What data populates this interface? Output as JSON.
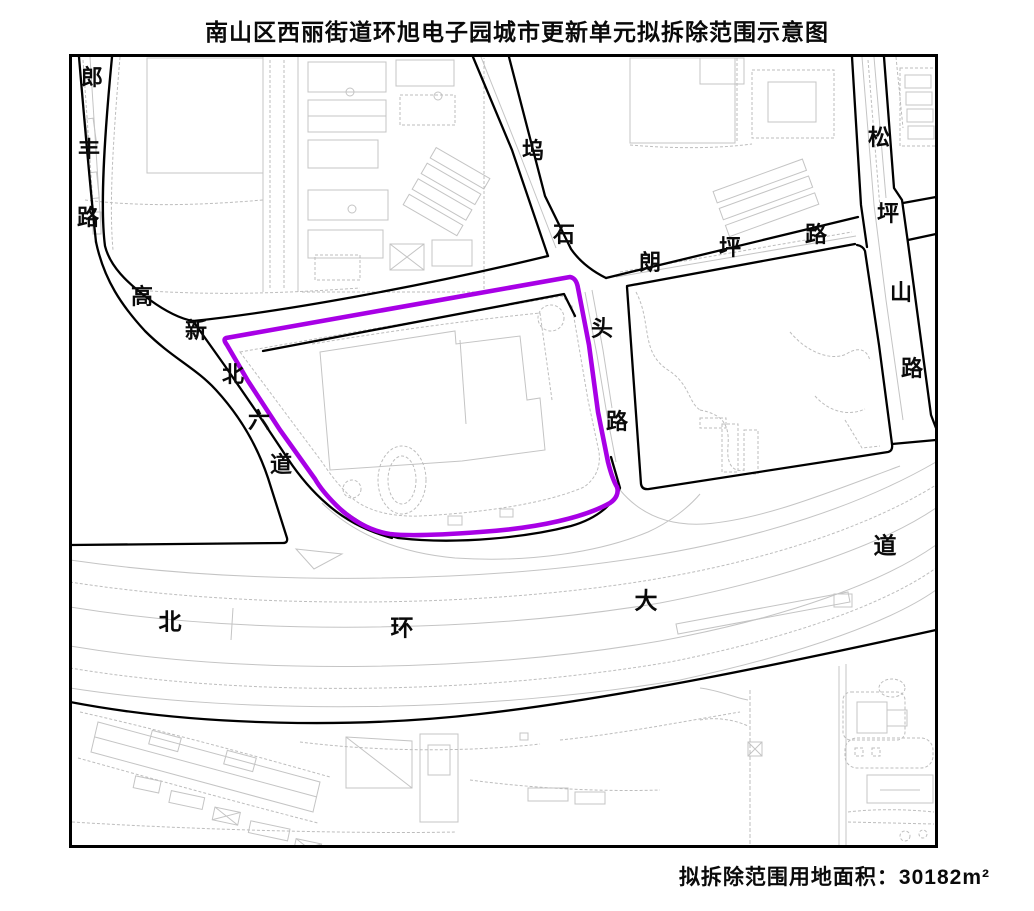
{
  "title": "南山区西丽街道环旭电子园城市更新单元拟拆除范围示意图",
  "footer": {
    "text": "拟拆除范围用地面积：30182m²",
    "area_value": "30182",
    "area_unit": "m²"
  },
  "map": {
    "boundary_color": "#A800E6",
    "frame_color": "#000000",
    "detail_color": "#c4c4c4",
    "roads": [
      {
        "id": "langfenglu",
        "name": "郎丰路",
        "chars": [
          "郎",
          "丰",
          "路"
        ]
      },
      {
        "id": "gaoxinbeiliudao",
        "name": "高新北六道",
        "chars": [
          "高",
          "新",
          "北",
          "六",
          "道"
        ]
      },
      {
        "id": "wushitoulu",
        "name": "坞石头路",
        "chars": [
          "坞",
          "石",
          "头",
          "路"
        ]
      },
      {
        "id": "langpinglu",
        "name": "朗坪路",
        "chars": [
          "朗",
          "坪",
          "路"
        ]
      },
      {
        "id": "songpingshanlu",
        "name": "松坪山路",
        "chars": [
          "松",
          "坪",
          "山",
          "路"
        ]
      },
      {
        "id": "beihuandadao",
        "name": "北环大道",
        "chars": [
          "北",
          "环",
          "大",
          "道"
        ]
      }
    ]
  }
}
